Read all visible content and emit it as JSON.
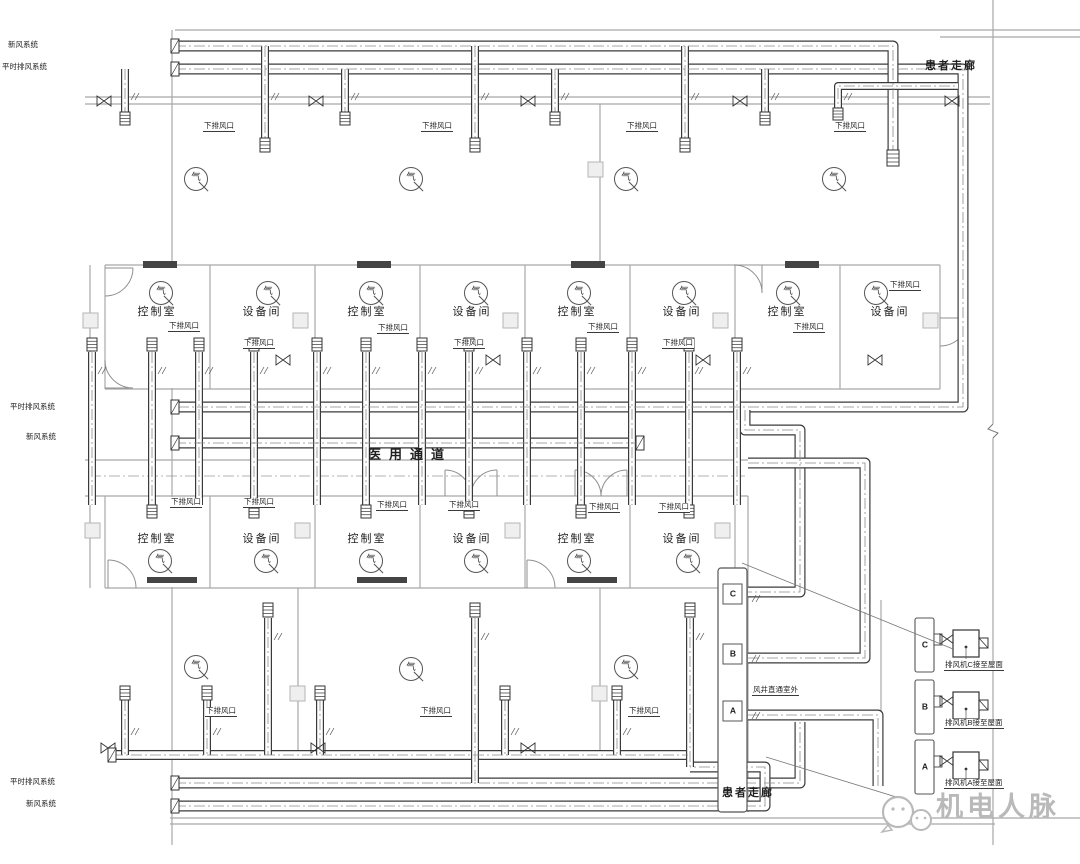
{
  "colors": {
    "duct_line": "#3a3a3a",
    "wall_line": "#a8a8a8",
    "text": "#1f1f1f",
    "watermark": "#b9b9b9"
  },
  "systems": {
    "fresh_air": "新风系统",
    "normal_exhaust": "平时排风系统"
  },
  "corridors": {
    "patient_top": "患者走廊",
    "patient_bottom": "患者走廊",
    "medical_passage": "医用通道"
  },
  "shaft": {
    "note": "风井直通室外",
    "risers": [
      {
        "id": "C"
      },
      {
        "id": "B"
      },
      {
        "id": "A"
      }
    ]
  },
  "fans": [
    {
      "id": "C",
      "note": "排风机C接至屋面"
    },
    {
      "id": "B",
      "note": "排风机B接至屋面"
    },
    {
      "id": "A",
      "note": "排风机A接至屋面"
    }
  ],
  "vent_outlet_label": "下排风口",
  "rooms": {
    "row1": [
      "控制室",
      "设备间",
      "控制室",
      "设备间",
      "控制室",
      "设备间",
      "控制室",
      "设备间"
    ],
    "row2": [
      "控制室",
      "设备间",
      "控制室",
      "设备间",
      "控制室",
      "设备间"
    ]
  },
  "symbols": {
    "gas": "气"
  },
  "watermark": {
    "text": "机电人脉"
  }
}
